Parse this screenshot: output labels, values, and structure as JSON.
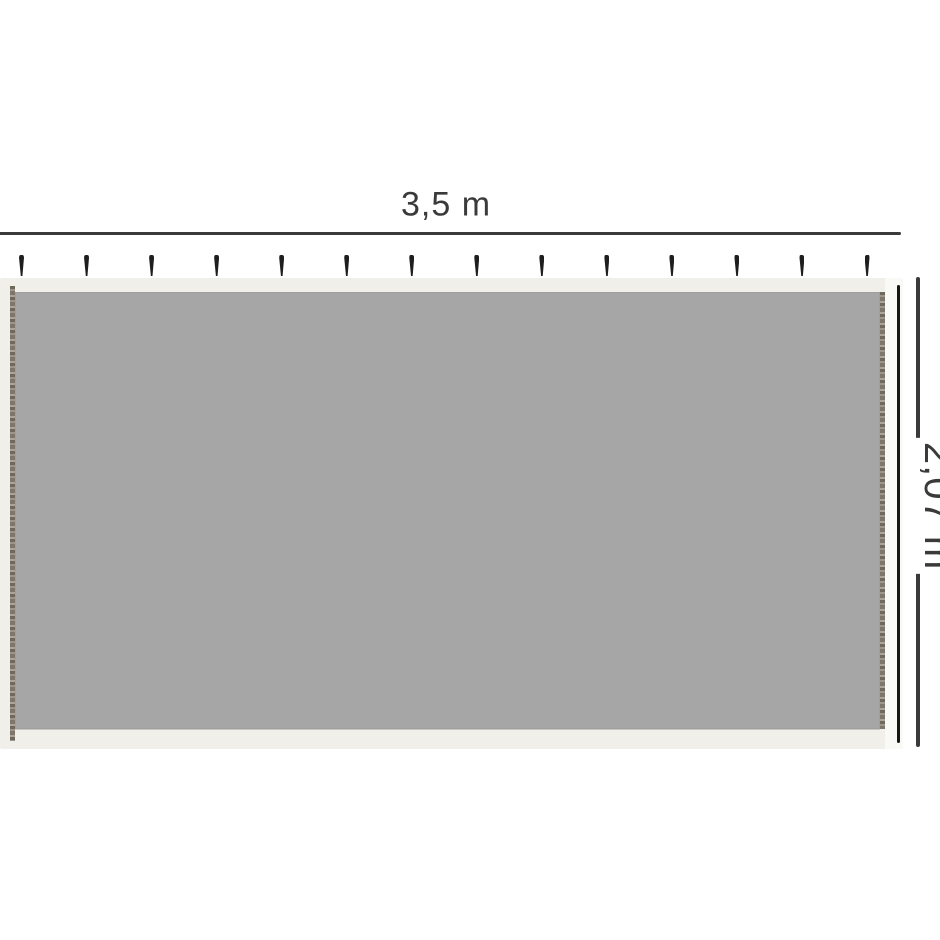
{
  "diagram": {
    "title": "panel-dimension-diagram",
    "width_label": "3,5 m",
    "height_label": "2,07 m",
    "hook_count": 14
  },
  "colors": {
    "background": "#ffffff",
    "dimension_line": "#3a3a3a",
    "mesh_gray": "#a6a6a6",
    "fabric_cream": "#f1efe9",
    "hook_black": "#1e1e1e",
    "zipper_black": "#161616"
  }
}
